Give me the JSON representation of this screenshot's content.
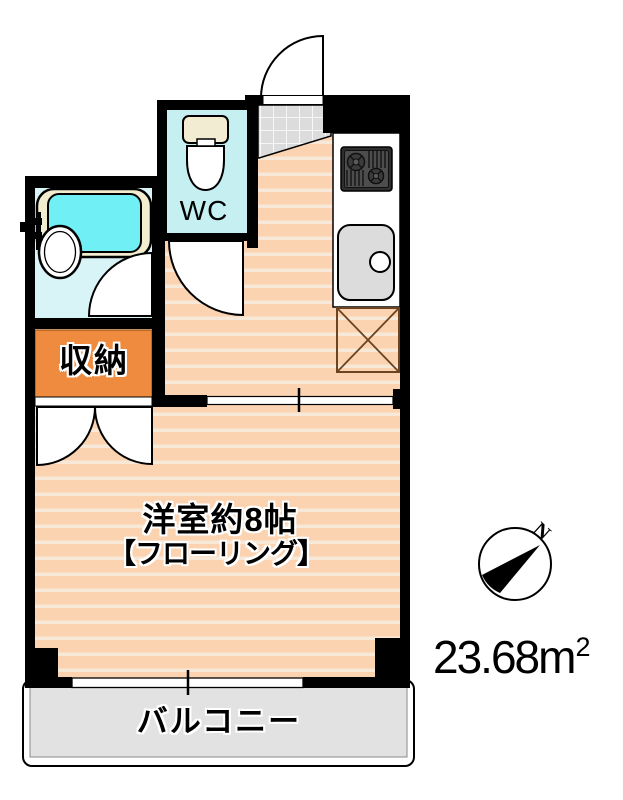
{
  "floorplan": {
    "labels": {
      "main_room_line1": "洋室約8帖",
      "main_room_line2": "【フローリング】",
      "closet": "収納",
      "wc": "WC",
      "balcony": "バルコニー"
    },
    "area": {
      "value": "23.68",
      "unit": "m",
      "exponent": "2"
    },
    "compass": {
      "north": "N"
    },
    "colors": {
      "wall": "#000000",
      "floor": "#FBD3B0",
      "floor_stripe": "#F8E8D7",
      "closet_fill": "#EF8B3E",
      "washroom_floor": "#D9F4F6",
      "wc_floor": "#C6EFF2",
      "bath_water": "#70EFF5",
      "bath_rim": "#F3EDCF",
      "balcony_fill": "#E2E2E2",
      "entrance_tile": "#DCDCDC",
      "kitchen_sink": "#DCDCDC",
      "refrigerator_outline": "#6B4423"
    },
    "fixtures": [
      "bathtub-icon",
      "washbasin-icon",
      "faucet-icon",
      "toilet-icon",
      "stove-icon",
      "kitchen-sink-icon",
      "refrigerator-space-icon",
      "entrance-door-icon",
      "wc-door-icon",
      "washroom-door-icon",
      "closet-doors-icon",
      "window",
      "sliding-partition",
      "compass-icon"
    ]
  }
}
